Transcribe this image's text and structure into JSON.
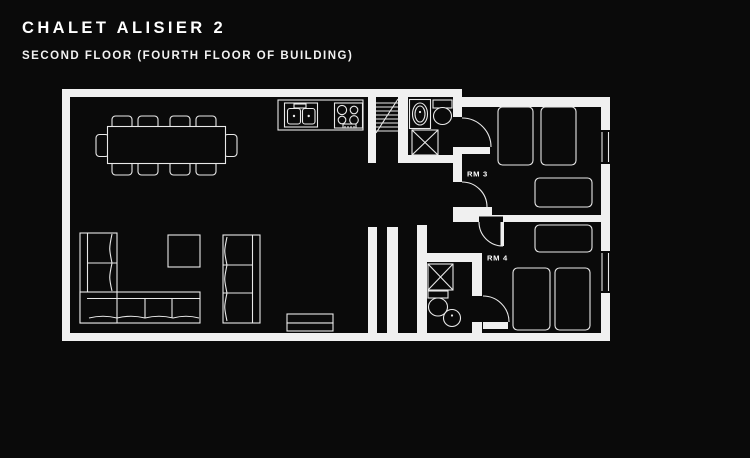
{
  "header": {
    "title": "CHALET ALISIER 2",
    "subtitle": "SECOND FLOOR (FOURTH FLOOR OF BUILDING)"
  },
  "floorplan": {
    "rooms": [
      {
        "id": "rm3",
        "label": "RM 3"
      },
      {
        "id": "rm4",
        "label": "RM 4"
      }
    ],
    "areas": [
      "open-plan-living-dining-kitchen",
      "staircase",
      "hallway",
      "ensuite-bathroom-rm3",
      "ensuite-bathroom-rm4"
    ],
    "furniture": {
      "dining": [
        "dining-table",
        "dining-chairs-x10"
      ],
      "kitchen": [
        "counter",
        "double-sink",
        "hob-4-burners"
      ],
      "living": [
        "corner-sofa",
        "sofa",
        "coffee-table",
        "tv-unit"
      ],
      "rm3": [
        "single-bed",
        "single-bed",
        "double-bed"
      ],
      "rm4": [
        "double-bed",
        "single-bed",
        "single-bed"
      ],
      "bathroom_each": [
        "shower",
        "toilet",
        "basin"
      ]
    },
    "windows_right_wall": 2,
    "colors": {
      "background": "#0a0a0a",
      "line": "#f0f0f0",
      "text": "#ffffff"
    }
  }
}
